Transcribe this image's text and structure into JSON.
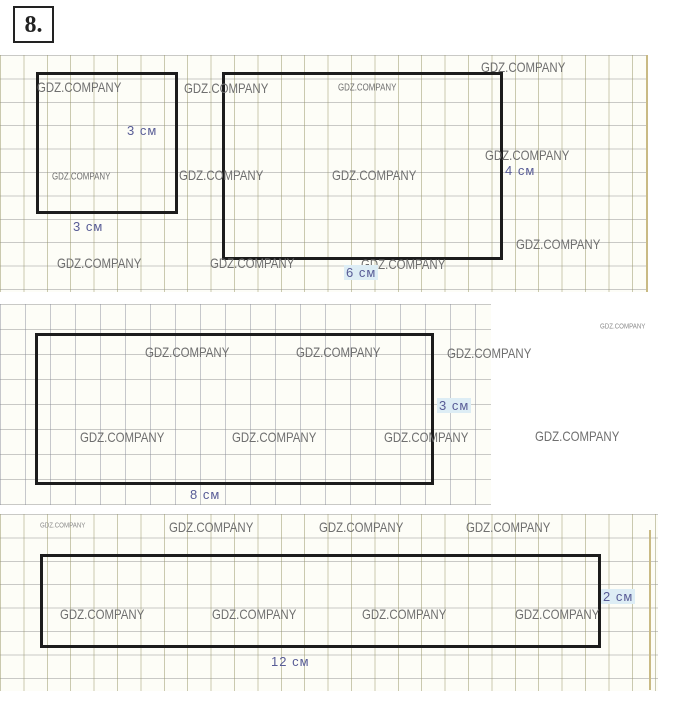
{
  "task_number": "8.",
  "watermark": "GDZ.COMPANY",
  "figures": {
    "square_3x3": {
      "shape": "square",
      "width_cm": 3,
      "height_cm": 3,
      "width_label": "3 см",
      "height_label": "3 см"
    },
    "rect_6x4": {
      "shape": "rectangle",
      "width_cm": 6,
      "height_cm": 4,
      "width_label": "6 см",
      "height_label": "4 см"
    },
    "rect_8x3": {
      "shape": "rectangle",
      "width_cm": 8,
      "height_cm": 3,
      "width_label": "8 см",
      "height_label": "3 см"
    },
    "rect_12x2": {
      "shape": "rectangle",
      "width_cm": 12,
      "height_cm": 2,
      "width_label": "12 см",
      "height_label": "2 см"
    }
  },
  "colors": {
    "outline": "#1c1c1c",
    "dimension_text": "#585c96",
    "watermark_text": "#6f6f6f",
    "grid_vertical": "#989668",
    "grid_horizontal": "#9e9e9e",
    "highlight": "#ddedf5"
  }
}
